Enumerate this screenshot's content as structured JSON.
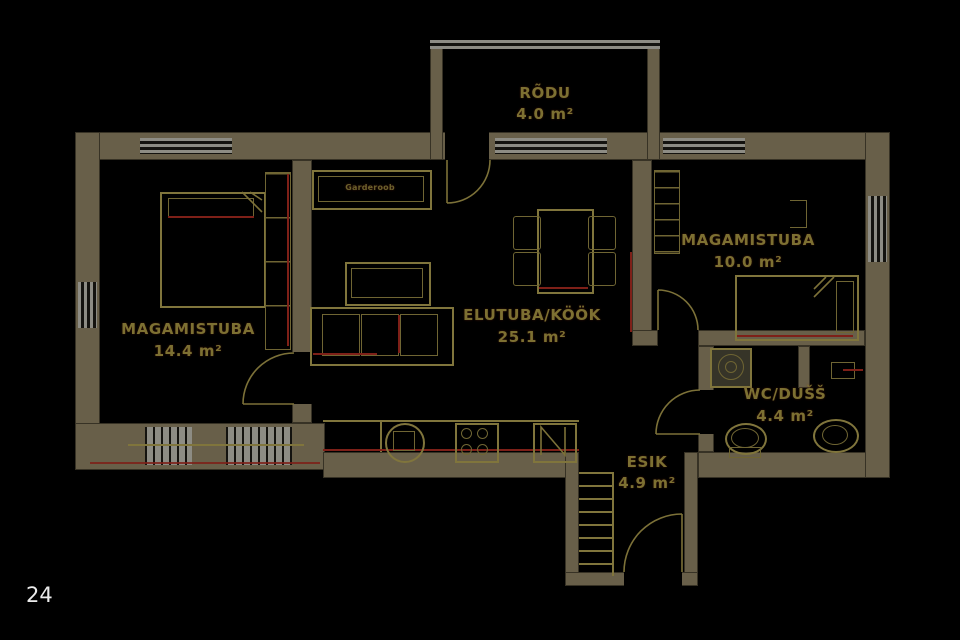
{
  "page": {
    "number": "24"
  },
  "plan": {
    "rooms": [
      {
        "name": "RÕDU",
        "area": "4.0 m²"
      },
      {
        "name": "MAGAMISTUBA",
        "area": "14.4 m²"
      },
      {
        "name": "ELUTUBA/KÖÖK",
        "area": "25.1 m²"
      },
      {
        "name": "MAGAMISTUBA",
        "area": "10.0 m²"
      },
      {
        "name": "WC/DUŠŠ",
        "area": "4.4 m²"
      },
      {
        "name": "ESIK",
        "area": "4.9 m²"
      }
    ],
    "annotations": {
      "closet": "Garderoob"
    },
    "palette": {
      "background": "#000000",
      "wall": "#685f49",
      "line": "#80753c",
      "accent_red": "#7e2018",
      "window": "#8d8c84",
      "label": "#7d7032",
      "page_number": "#ececec"
    }
  }
}
